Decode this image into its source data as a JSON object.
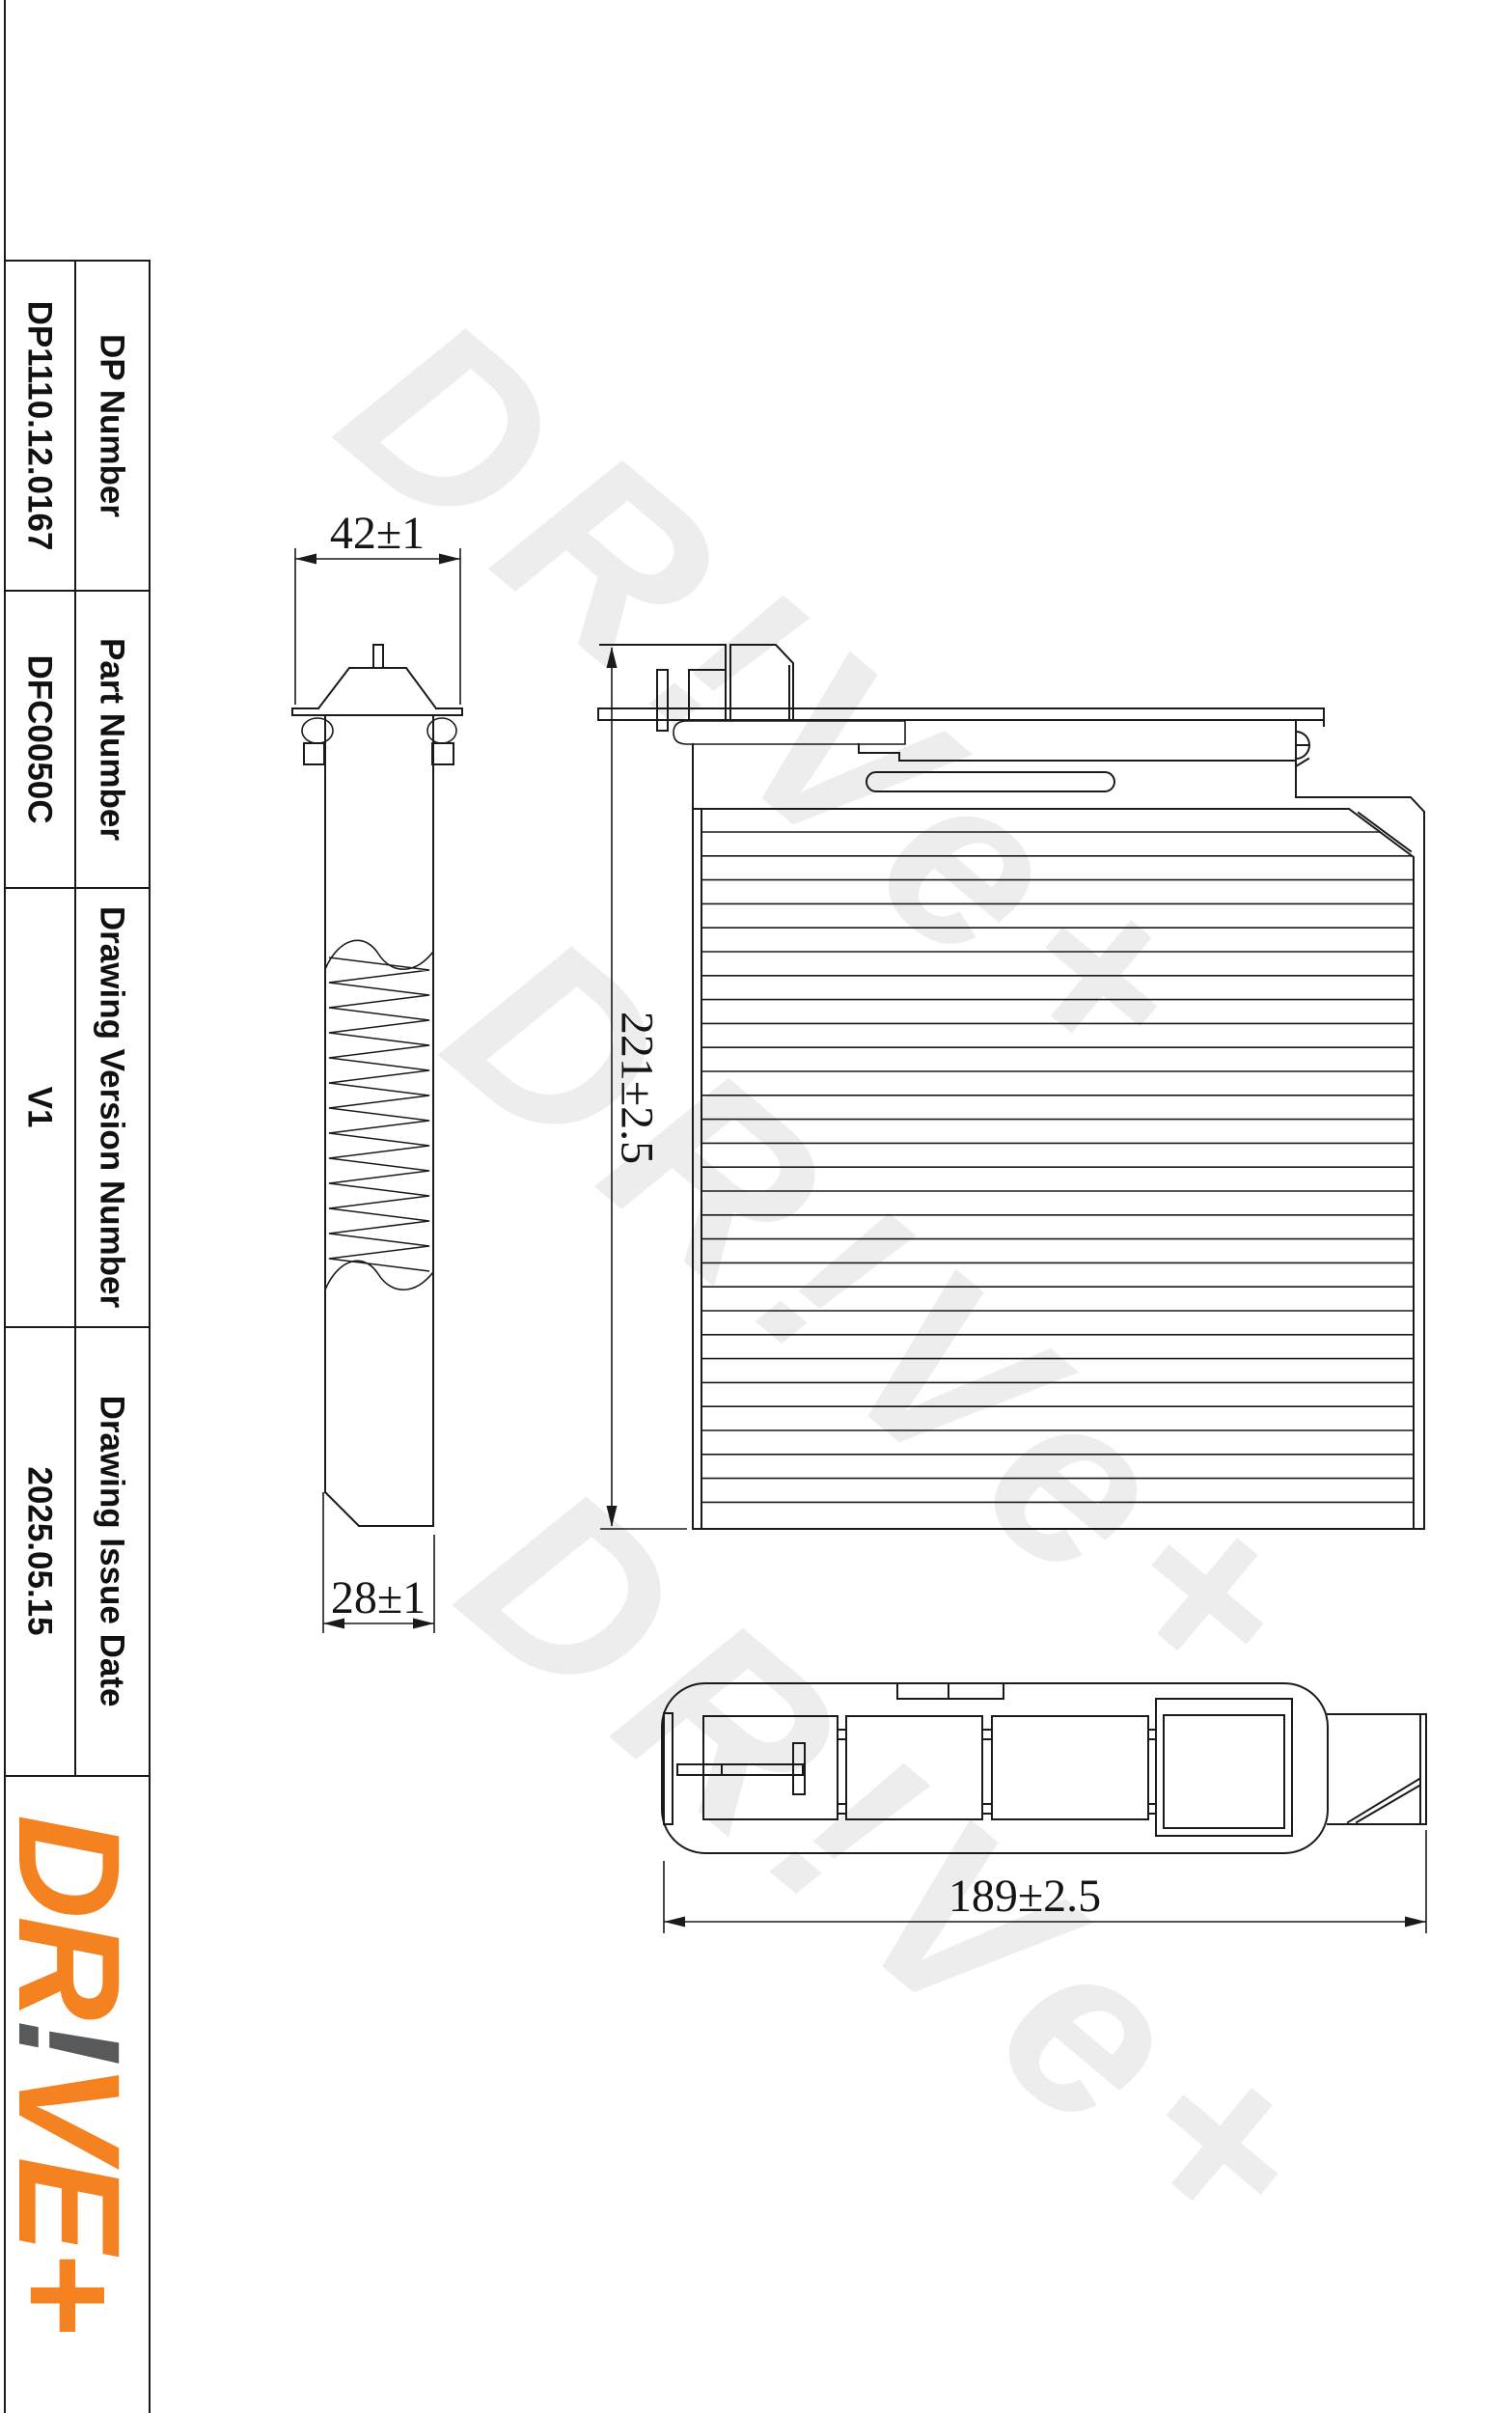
{
  "title_block": {
    "rows": [
      {
        "label": "DP Number",
        "value": "DP1110.12.0167"
      },
      {
        "label": "Part Number",
        "value": "DFC0050C"
      },
      {
        "label": "Drawing Version Number",
        "value": "V1"
      },
      {
        "label": "Drawing Issue Date",
        "value": "2025.05.15"
      }
    ]
  },
  "logo": {
    "part1": "DR",
    "bang": "!",
    "part2": "VE+"
  },
  "watermark": {
    "text": "DR!Ve+"
  },
  "views": {
    "side": {
      "width_dim": "42±1",
      "bottom_dim": "28±1"
    },
    "front": {
      "height_dim": "221±2.5"
    },
    "bottom": {
      "width_dim": "189±2.5"
    }
  },
  "colors": {
    "line": "#1a1a1a",
    "watermark": "#ededed",
    "logo_orange": "#F58220",
    "logo_gray": "#58595B"
  }
}
